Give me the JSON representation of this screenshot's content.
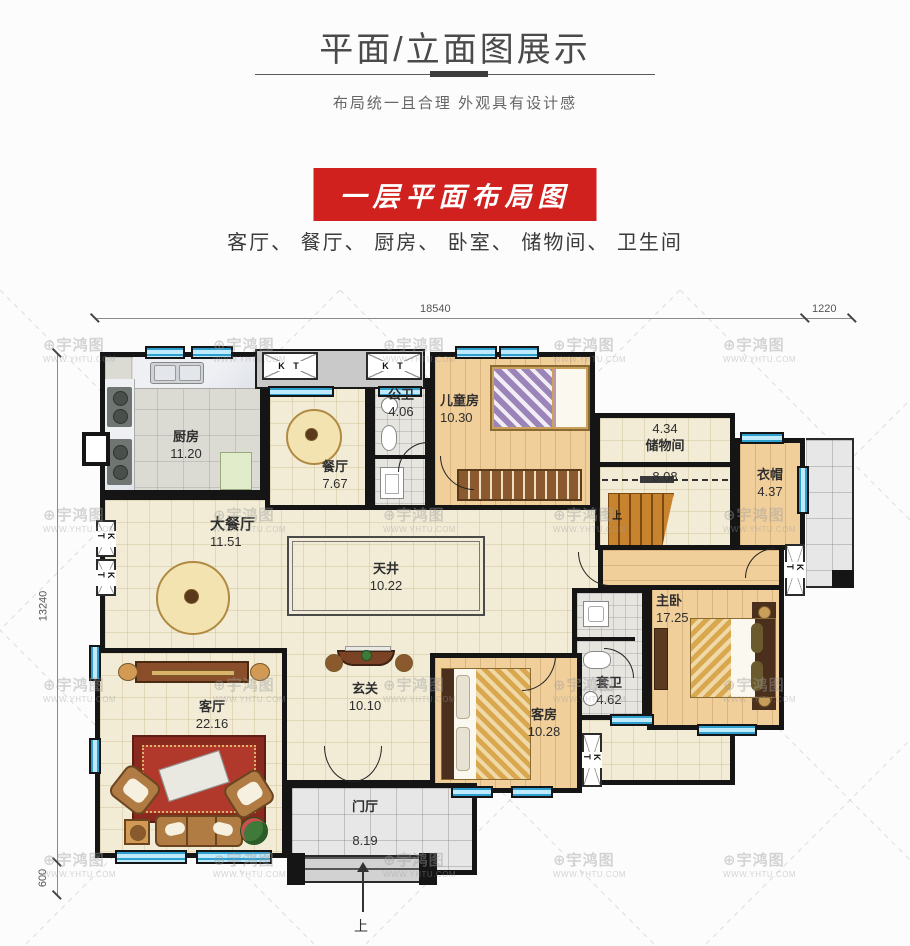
{
  "header": {
    "title": "平面/立面图展示",
    "subtitle": "布局统一且合理  外观具有设计感"
  },
  "banner": {
    "label": "一层平面布局图",
    "color": "#d0211f"
  },
  "room_list": "客厅、 餐厅、 厨房、 卧室、 储物间、 卫生间",
  "dimensions": {
    "top_main": "18540",
    "top_right": "1220",
    "left_main": "13240",
    "left_bottom": "600"
  },
  "watermark": {
    "brand": "宇鸿图",
    "logo": "⊕",
    "url": "WWW.YHTU.COM"
  },
  "plan": {
    "rooms": {
      "kitchen": {
        "name": "厨房",
        "area": "11.20"
      },
      "dining": {
        "name": "餐厅",
        "area": "7.67"
      },
      "public_bath": {
        "name": "公卫",
        "area": "4.06"
      },
      "kids_room": {
        "name": "儿童房",
        "area": "10.30"
      },
      "storage": {
        "name": "储物间",
        "area": "4.34"
      },
      "stair_hall": {
        "area": "8.08"
      },
      "cloakroom": {
        "name": "衣帽",
        "area": "4.37"
      },
      "grand_dining": {
        "name": "大餐厅",
        "area": "11.51"
      },
      "atrium": {
        "name": "天井",
        "area": "10.22"
      },
      "foyer": {
        "name": "玄关",
        "area": "10.10"
      },
      "living": {
        "name": "客厅",
        "area": "22.16"
      },
      "guest_room": {
        "name": "客房",
        "area": "10.28"
      },
      "ensuite_bath": {
        "name": "套卫",
        "area": "4.62"
      },
      "master": {
        "name": "主卧",
        "area": "17.25"
      },
      "porch": {
        "name": "门厅",
        "area": "8.19"
      }
    },
    "labels": {
      "ac_unit": "K T",
      "stairs_up": "上",
      "entry_up": "上"
    }
  }
}
